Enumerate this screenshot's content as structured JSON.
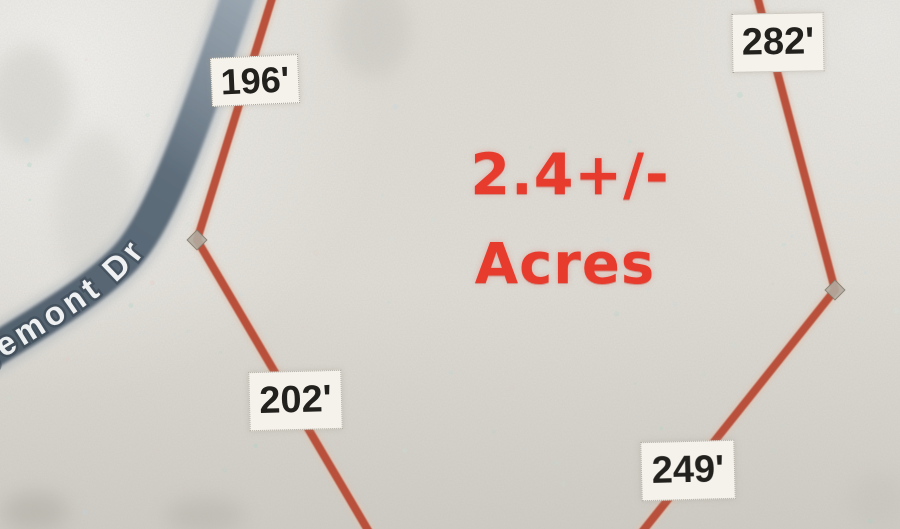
{
  "map": {
    "type": "plat-parcel-map",
    "area_label": {
      "line1": "2.4+/-",
      "line2": "Acres"
    },
    "road": {
      "name": "gemont Dr"
    },
    "measurements": [
      {
        "side": "northwest",
        "text": "196'"
      },
      {
        "side": "northeast",
        "text": "282'"
      },
      {
        "side": "southwest",
        "text": "202'"
      },
      {
        "side": "southeast",
        "text": "249'"
      }
    ],
    "colors": {
      "boundary_line": "#b5452f",
      "area_text": "#e73b2e",
      "road_fill": "#5b6a78",
      "paper": "#e0ddd6",
      "label_background": "#f5f2ec",
      "label_text": "#23211e"
    }
  }
}
